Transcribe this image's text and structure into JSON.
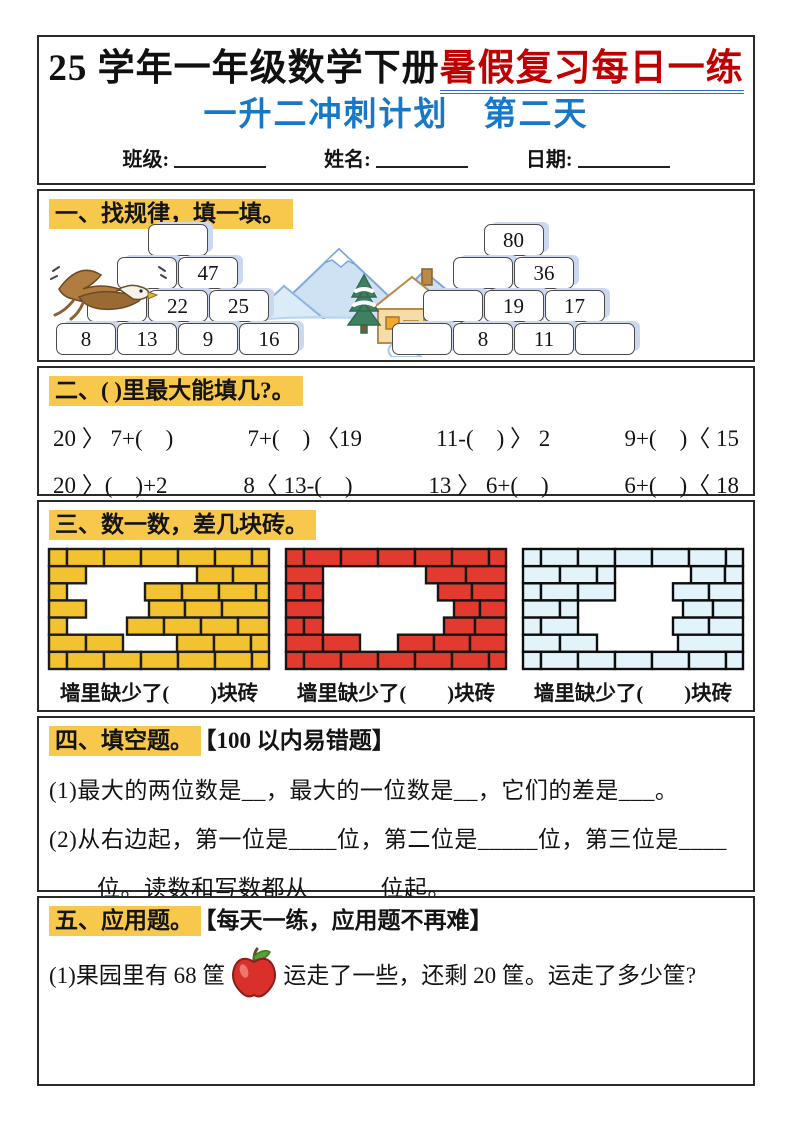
{
  "colors": {
    "highlight": "#f7c84b",
    "red_title": "#c00000",
    "blue": "#1878c8",
    "underline": "#2f6ebf",
    "wall_yellow": "#f2c231",
    "wall_red": "#e23a2e",
    "wall_blue": "#e2f4fa",
    "brick_shadow": "#ccd8f0"
  },
  "header": {
    "title_black": "25 学年一年级数学下册",
    "title_red": "暑假复习每日一练",
    "subtitle": "一升二冲刺计划　第二天",
    "fields": [
      {
        "label": "班级:"
      },
      {
        "label": "姓名:"
      },
      {
        "label": "日期:"
      }
    ]
  },
  "s1": {
    "title": "一、找规律，填一填。",
    "left_pyramid": [
      [
        ""
      ],
      [
        "",
        "47"
      ],
      [
        "",
        "22",
        "25"
      ],
      [
        "8",
        "13",
        "9",
        "16"
      ]
    ],
    "right_pyramid": [
      [
        "80"
      ],
      [
        "",
        "36"
      ],
      [
        "",
        "19",
        "17"
      ],
      [
        "",
        "8",
        "11",
        ""
      ]
    ]
  },
  "s2": {
    "title": "二、( )里最大能填几?。",
    "rows": [
      [
        "20 〉 7+(　)",
        "7+(　) 〈19",
        "11-(　) 〉 2",
        "9+(　)〈 15"
      ],
      [
        "20 〉(　)+2",
        "8〈 13-(　)",
        "13 〉 6+(　)",
        "6+(　)〈 18"
      ]
    ]
  },
  "s3": {
    "title": "三、数一数，差几块砖。",
    "captions": [
      "墙里缺少了(　　)块砖",
      "墙里缺少了(　　)块砖",
      "墙里缺少了(　　)块砖"
    ],
    "walls": [
      {
        "color": "wall_yellow",
        "stroke": "#1c1c1c",
        "rows": [
          [
            [
              0,
              18
            ],
            [
              18,
              37
            ],
            [
              55,
              37
            ],
            [
              92,
              37
            ],
            [
              129,
              37
            ],
            [
              166,
              37
            ],
            [
              203,
              17
            ]
          ],
          [
            [
              0,
              37
            ],
            [
              148,
              36
            ],
            [
              184,
              36
            ]
          ],
          [
            [
              0,
              18
            ],
            [
              96,
              37
            ],
            [
              133,
              37
            ],
            [
              170,
              37
            ],
            [
              207,
              13
            ]
          ],
          [
            [
              0,
              37
            ],
            [
              100,
              36
            ],
            [
              136,
              37
            ],
            [
              173,
              47
            ]
          ],
          [
            [
              0,
              18
            ],
            [
              78,
              37
            ],
            [
              115,
              37
            ],
            [
              152,
              37
            ],
            [
              189,
              31
            ]
          ],
          [
            [
              0,
              37
            ],
            [
              37,
              37
            ],
            [
              128,
              37
            ],
            [
              165,
              37
            ],
            [
              202,
              18
            ]
          ],
          [
            [
              0,
              18
            ],
            [
              18,
              37
            ],
            [
              55,
              37
            ],
            [
              92,
              37
            ],
            [
              129,
              37
            ],
            [
              166,
              37
            ],
            [
              203,
              17
            ]
          ]
        ]
      },
      {
        "color": "wall_red",
        "stroke": "#151515",
        "rows": [
          [
            [
              0,
              18
            ],
            [
              18,
              37
            ],
            [
              55,
              37
            ],
            [
              92,
              37
            ],
            [
              129,
              37
            ],
            [
              166,
              37
            ],
            [
              203,
              17
            ]
          ],
          [
            [
              0,
              37
            ],
            [
              140,
              40
            ],
            [
              180,
              40
            ]
          ],
          [
            [
              0,
              18
            ],
            [
              18,
              19
            ],
            [
              152,
              34
            ],
            [
              186,
              34
            ]
          ],
          [
            [
              0,
              37
            ],
            [
              168,
              26
            ],
            [
              194,
              26
            ]
          ],
          [
            [
              0,
              18
            ],
            [
              18,
              19
            ],
            [
              158,
              31
            ],
            [
              189,
              31
            ]
          ],
          [
            [
              0,
              37
            ],
            [
              37,
              37
            ],
            [
              112,
              36
            ],
            [
              148,
              36
            ],
            [
              184,
              36
            ]
          ],
          [
            [
              0,
              18
            ],
            [
              18,
              37
            ],
            [
              55,
              37
            ],
            [
              92,
              37
            ],
            [
              129,
              37
            ],
            [
              166,
              37
            ],
            [
              203,
              17
            ]
          ]
        ]
      },
      {
        "color": "wall_blue",
        "stroke": "#0d0d0d",
        "rows": [
          [
            [
              0,
              18
            ],
            [
              18,
              37
            ],
            [
              55,
              37
            ],
            [
              92,
              37
            ],
            [
              129,
              37
            ],
            [
              166,
              37
            ],
            [
              203,
              17
            ]
          ],
          [
            [
              0,
              37
            ],
            [
              37,
              37
            ],
            [
              74,
              18
            ],
            [
              168,
              34
            ],
            [
              202,
              18
            ]
          ],
          [
            [
              0,
              18
            ],
            [
              18,
              37
            ],
            [
              55,
              37
            ],
            [
              150,
              36
            ],
            [
              186,
              34
            ]
          ],
          [
            [
              0,
              37
            ],
            [
              37,
              18
            ],
            [
              160,
              30
            ],
            [
              190,
              30
            ]
          ],
          [
            [
              0,
              18
            ],
            [
              18,
              37
            ],
            [
              150,
              36
            ],
            [
              186,
              34
            ]
          ],
          [
            [
              0,
              37
            ],
            [
              37,
              37
            ],
            [
              155,
              65
            ]
          ],
          [
            [
              0,
              18
            ],
            [
              18,
              37
            ],
            [
              55,
              37
            ],
            [
              92,
              37
            ],
            [
              129,
              37
            ],
            [
              166,
              37
            ],
            [
              203,
              17
            ]
          ]
        ]
      }
    ]
  },
  "s4": {
    "title": "四、填空题。",
    "subtitle": "【100 以内易错题】",
    "lines": [
      "(1)最大的两位数是__，最大的一位数是__，它们的差是___。",
      "(2)从右边起，第一位是____位，第二位是_____位，第三位是____",
      "____位。读数和写数都从______位起。"
    ]
  },
  "s5": {
    "title": "五、应用题。",
    "subtitle": "【每天一练，应用题不再难】",
    "before_apple": "(1)果园里有 68 筐",
    "after_apple": "运走了一些，还剩 20 筐。运走了多少筐?"
  }
}
